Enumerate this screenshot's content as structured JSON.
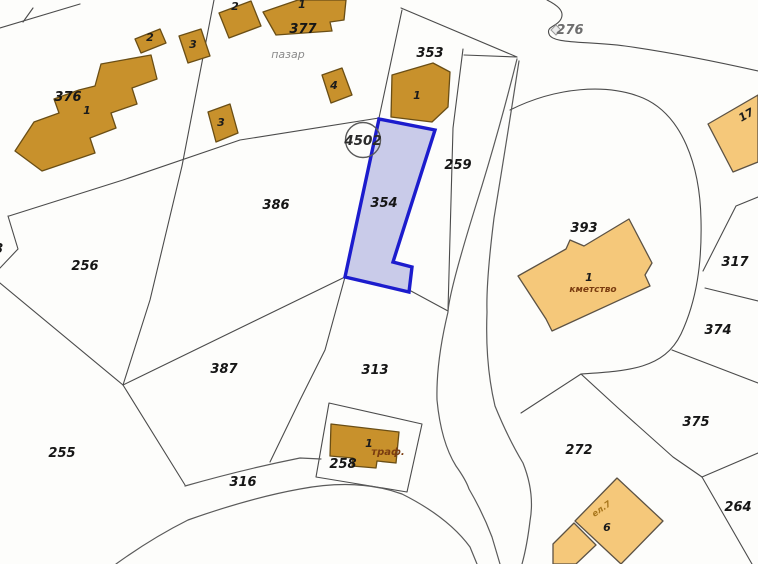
{
  "map": {
    "width": 758,
    "height": 564,
    "background_color": "#fdfdfb",
    "boundary_color": "#4b4b4b",
    "highlight_parcel": {
      "number": "354",
      "fill": "#c9cbe9",
      "stroke": "#1c1ccd"
    },
    "building_colors": {
      "dark_fill": "#c8912c",
      "dark_stroke": "#6a4e15",
      "light_fill": "#f5c87a",
      "light_stroke": "#5c5244"
    }
  },
  "labels": {
    "parcels": [
      {
        "text": "376",
        "x": 68,
        "y": 101
      },
      {
        "text": "377",
        "x": 303,
        "y": 33
      },
      {
        "text": "353",
        "x": 430,
        "y": 57
      },
      {
        "text": "386",
        "x": 276,
        "y": 209
      },
      {
        "text": "256",
        "x": 85,
        "y": 270
      },
      {
        "text": "255",
        "x": 62,
        "y": 457
      },
      {
        "text": "387",
        "x": 224,
        "y": 373
      },
      {
        "text": "316",
        "x": 243,
        "y": 486
      },
      {
        "text": "313",
        "x": 375,
        "y": 374
      },
      {
        "text": "258",
        "x": 343,
        "y": 468
      },
      {
        "text": "259",
        "x": 458,
        "y": 169
      },
      {
        "text": "354",
        "x": 384,
        "y": 207
      },
      {
        "text": "393",
        "x": 584,
        "y": 232
      },
      {
        "text": "317",
        "x": 735,
        "y": 266
      },
      {
        "text": "374",
        "x": 718,
        "y": 334
      },
      {
        "text": "375",
        "x": 696,
        "y": 426
      },
      {
        "text": "272",
        "x": 579,
        "y": 454
      },
      {
        "text": "264",
        "x": 738,
        "y": 511
      },
      {
        "text": "276",
        "x": 570,
        "y": 34,
        "muted": true
      },
      {
        "text": "18",
        "x": -6,
        "y": 253
      }
    ],
    "buildings": [
      {
        "text": "1",
        "x": 87,
        "y": 114
      },
      {
        "text": "2",
        "x": 150,
        "y": 41
      },
      {
        "text": "3",
        "x": 193,
        "y": 48
      },
      {
        "text": "2",
        "x": 235,
        "y": 10
      },
      {
        "text": "1",
        "x": 302,
        "y": 8
      },
      {
        "text": "4",
        "x": 334,
        "y": 89
      },
      {
        "text": "3",
        "x": 221,
        "y": 126
      },
      {
        "text": "1",
        "x": 417,
        "y": 99
      },
      {
        "text": "1",
        "x": 369,
        "y": 447
      },
      {
        "text": "1",
        "x": 589,
        "y": 281
      },
      {
        "text": "6",
        "x": 607,
        "y": 531
      },
      {
        "text": "17",
        "x": 748,
        "y": 118,
        "rotate": -30
      }
    ],
    "annotations": [
      {
        "text": "пазар",
        "x": 288,
        "y": 58,
        "size": 11,
        "color": "#8a8a8a"
      },
      {
        "text": "траф.",
        "x": 388,
        "y": 455,
        "size": 10,
        "color": "#7a3c10",
        "bold": true
      },
      {
        "text": "кметство",
        "x": 593,
        "y": 292,
        "size": 9,
        "color": "#7a3c10",
        "bold": true
      },
      {
        "text": "ел.7",
        "x": 603,
        "y": 511,
        "size": 8.5,
        "color": "#a8761c",
        "rotate": -35,
        "bold": true
      }
    ],
    "circled_point": {
      "text": "4502",
      "x": 363,
      "y": 140,
      "r": 17.5
    }
  }
}
